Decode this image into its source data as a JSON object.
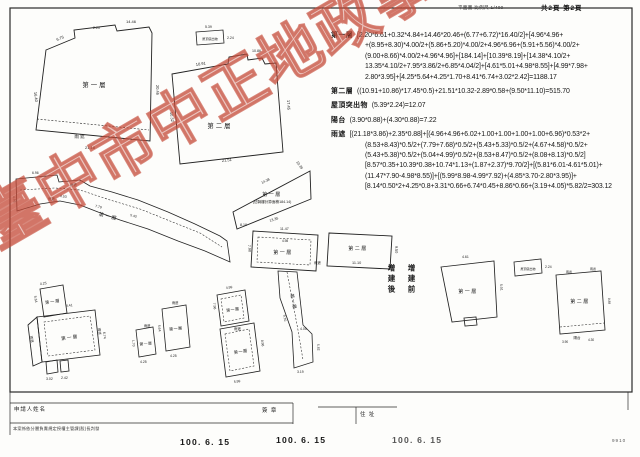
{
  "header": {
    "scale": "平面圖 比例尺 1/400",
    "page": "共2頁 第2頁"
  },
  "calc": {
    "floor1_label": "第一層",
    "floor1_lines": [
      "[2.20*6.61+0.32*4.84+14.46*20.46+(6.77+6.72)*16.40/2]+[4.96*4.96+",
      "+(8.95+8.30)*4.00/2+(5.86+5.20)*4.00/2+4.96*6.96+(5.91+5.56)*4.00/2+",
      "(9.00+8.66)*4.00/2+4.96*4.96]+[184.14]+[10.39*8.19]+[14.38*4.10/2+",
      "13.35*4.10/2+7.95*3.86/2+6.85*4.04/2]+[4.61*5.01+4.98*8.55]+[4.99*7.98+",
      "2.80*3.95]+[4.25*5.64+4.25*1.70+8.41*6.74+3.02*2.42]=1188.17"
    ],
    "floor2_label": "第二層",
    "floor2_line": "((10.91+10.86)*17.45*0.5)+21.51*10.32-2.89*0.58+(9.50*11.10)=515.70",
    "roof_label": "屋頂突出物",
    "roof_line": "(5.39*2.24)=12.07",
    "balcony_label": "陽台",
    "balcony_line": "(3.90*0.88)+(4.30*0.88)=7.22",
    "canopy_label": "雨遮",
    "canopy_lines": [
      "[(21.18*3.86)+2.35*0.88]+[(4.96+4.96+6.02+1.00+1.00+1.00+1.00+6.96)*0.53*2+",
      "(8.53+8.43)*0.5/2+(7.79+7.68)*0.5/2+(5.43+5.33)*0.5/2+(4.67+4.58)*0.5/2+",
      "(5.43+5.38)*0.5/2+(5.04+4.99)*0.5/2+(8.53+8.47)*0.5/2+(8.08+8.13)*0.5/2]",
      "[8.57*0.35+10.39*0.38+10.74*1.13+(1.87+2.37)*9.70/2]+[(5.81*6.01-4.61*5.01)+",
      "(11.47*7.90-4.98*8.55)]+[(5.99*8.98-4.99*7.92)+(4.85*3.70-2.80*3.95)]+",
      "[8.14*0.50*2+4.25*0.8+3.31*0.66+6.74*0.45+8.86*0.66+(3.19+4.05)*5.82/2=303.12"
    ]
  },
  "plans": {
    "floor1": "第一層",
    "floor2": "第二層",
    "roof": "屋頂突出物",
    "canopy": "雨遮",
    "balcony": "陽台",
    "arcade_note": "(佔騎樓計算面積184.14)",
    "dims": {
      "s1a": "6.75",
      "s1b": "14.46",
      "s1c": "20.46",
      "s1d": "16.40",
      "s1e": "21.18",
      "s1f": "2.20",
      "s2a": "10.91",
      "s2b": "10.86",
      "s2c": "17.45",
      "s2d": "21.51",
      "s2e": "10.32",
      "r1a": "5.39",
      "r1b": "2.24",
      "sna": "8.53",
      "snb": "7.79",
      "snc": "5.43",
      "snd": "4.96",
      "sne": "6.96",
      "ta": "14.38",
      "tb": "13.35",
      "tc": "10.39",
      "td": "8.19",
      "da": "11.47",
      "db": "7.90",
      "dc": "4.98",
      "ea": "11.10",
      "eb": "9.50",
      "fa": "9.70",
      "fb": "4.05",
      "fc": "5.82",
      "fd": "3.19",
      "ga": "8.41",
      "gb": "6.74",
      "gc": "3.02",
      "gd": "2.42",
      "ge": "4.25",
      "gf": "5.64",
      "h1a": "4.25",
      "h1b": "1.70",
      "h2a": "4.25",
      "h2b": "5.64",
      "ia": "4.99",
      "ib": "7.98",
      "ic": "5.99",
      "id": "8.98",
      "ra": "4.61",
      "rb": "5.01",
      "rc": "2.24",
      "rd": "3.90",
      "re": "4.30",
      "rf": "0.88"
    }
  },
  "annotations": {
    "after": "增建後",
    "before": "增建前"
  },
  "watermark": {
    "text": "臺中市中正地政事務所",
    "color": "#c54a38"
  },
  "footer": {
    "applicant_label": "申請人姓名",
    "signature_label": "簽 章",
    "address_label": "住 址",
    "disclaimer": "本案係依分層負責規定授權主管課(股)長判發",
    "dates": {
      "d1": "100. 6. 15",
      "d2": "100. 6. 15",
      "d3": "100. 6. 15"
    },
    "corner_code": "9910"
  }
}
